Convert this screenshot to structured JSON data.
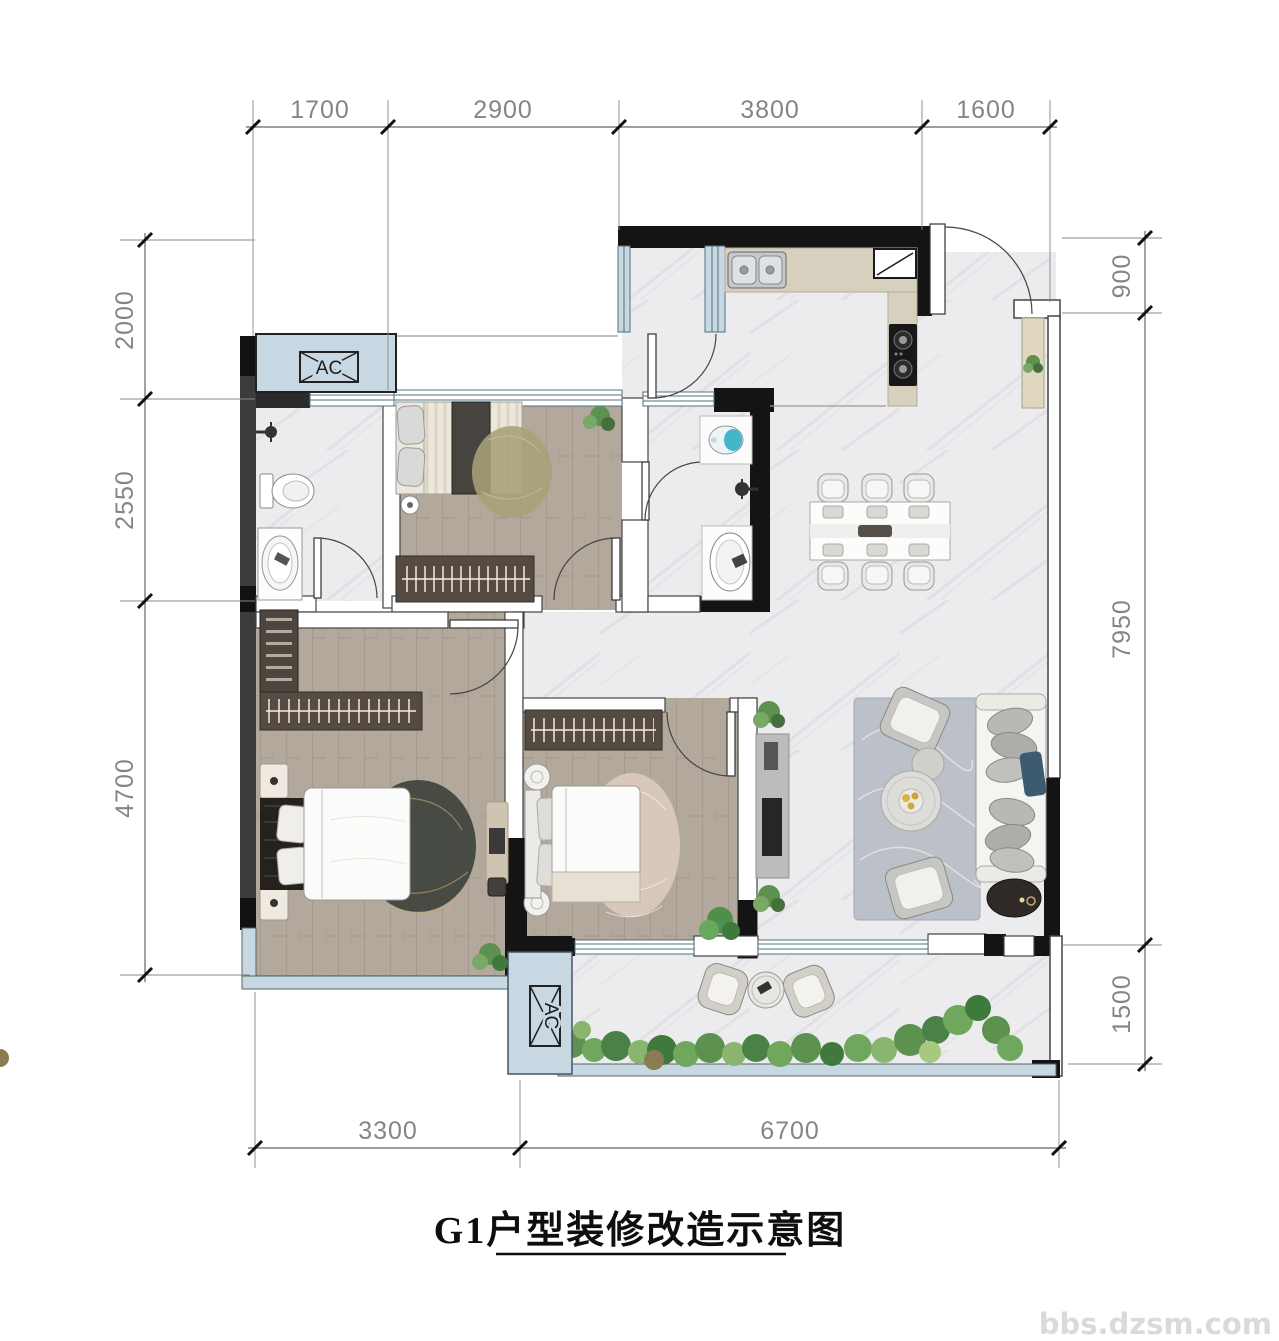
{
  "plan": {
    "title": "G1户型装修改造示意图",
    "watermark": "bbs.dzsm.com",
    "ac_label": "AC"
  },
  "dimensions": {
    "top": [
      "1700",
      "2900",
      "3800",
      "1600"
    ],
    "left": [
      "2000",
      "2550",
      "4700"
    ],
    "right": [
      "900",
      "7950",
      "1500"
    ],
    "bottom": [
      "3300",
      "6700"
    ]
  },
  "colors": {
    "wall_black": "#141414",
    "wall_gray": "#3c3c3c",
    "window_blue": "#c7d8e2",
    "wood_floor": "#b3a89c",
    "marble_floor": "#ececee",
    "counter_tan": "#d7d0be",
    "plant_green": "#5d9150"
  }
}
